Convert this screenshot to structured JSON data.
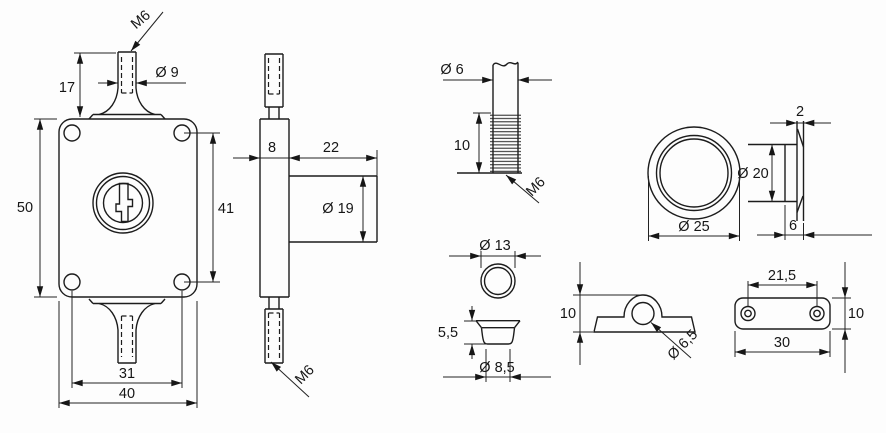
{
  "drawing": {
    "ink_color": "#1c1c1c",
    "background_color": "#fdfdfd",
    "views": {
      "lock_front": {
        "thread_label": "M6",
        "post_diameter": "Ø 9",
        "post_height": "17",
        "body_height": "50",
        "hole_spacing_vertical": "41",
        "hole_spacing_horizontal": "31",
        "body_width": "40"
      },
      "lock_side": {
        "body_thickness": "8",
        "cylinder_length": "22",
        "cylinder_diameter": "Ø 19",
        "thread_label": "M6"
      },
      "threaded_rod": {
        "rod_diameter": "Ø 6",
        "thread_length": "10",
        "thread_label": "M6"
      },
      "ferrule": {
        "flange_diameter": "Ø 13",
        "height": "5,5",
        "body_diameter": "Ø 8,5"
      },
      "ring": {
        "rim_thickness": "2",
        "inner_diameter": "Ø 20",
        "outer_diameter": "Ø 25",
        "depth": "6"
      },
      "saddle_bracket": {
        "height": "10",
        "hole_diameter": "Ø 6,5"
      },
      "plate": {
        "hole_spacing": "21,5",
        "length": "30",
        "width": "10"
      }
    }
  }
}
